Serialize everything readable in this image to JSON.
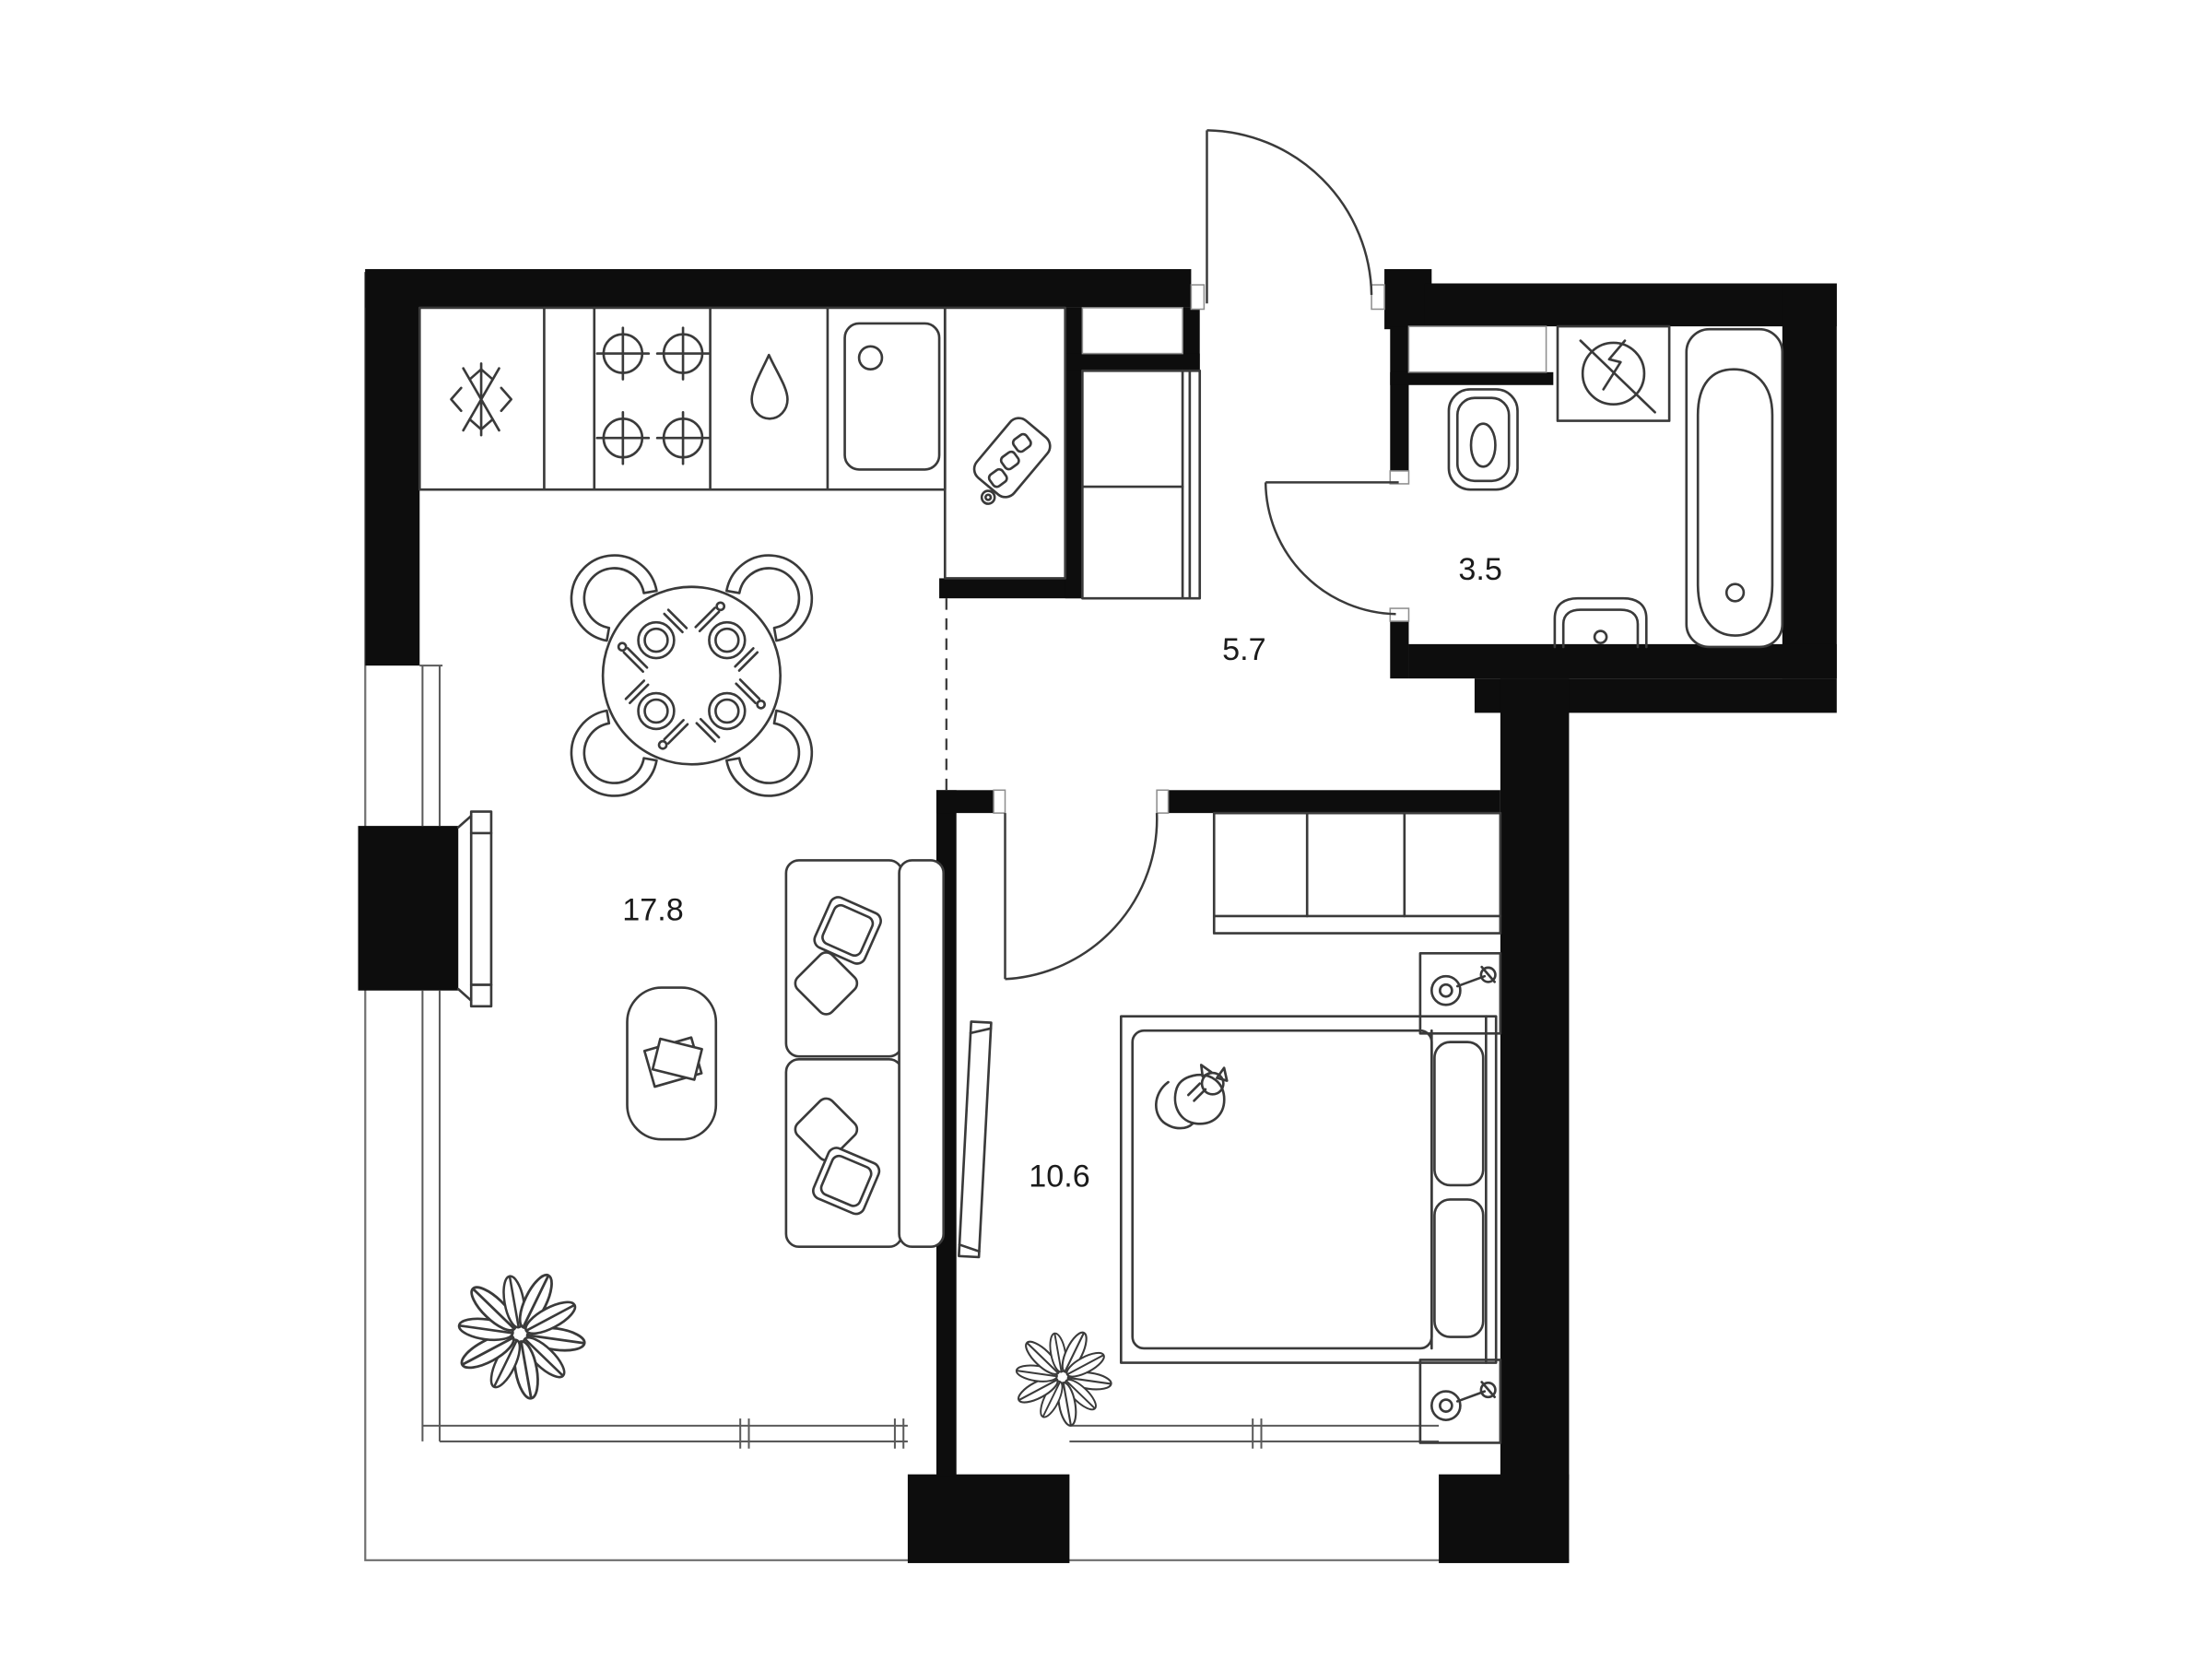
{
  "plan": {
    "type": "apartment-floor-plan",
    "rooms": [
      {
        "key": "living-kitchen",
        "area_label": "17.8"
      },
      {
        "key": "hallway",
        "area_label": "5.7"
      },
      {
        "key": "bathroom",
        "area_label": "3.5"
      },
      {
        "key": "bedroom",
        "area_label": "10.6"
      }
    ],
    "colors": {
      "wall": "#0d0d0d",
      "furniture_line": "#3a3a3a",
      "background": "#ffffff"
    },
    "icons": [
      "fridge-snowflake-icon",
      "stove-burners-icon",
      "dishwasher-drop-icon",
      "kitchen-sink-icon",
      "cutting-board-icon",
      "dining-table-icon",
      "chair-icon",
      "place-setting-icon",
      "sofa-icon",
      "pillow-icon",
      "coffee-table-icon",
      "plant-icon",
      "balcony-door-icon",
      "entrance-door-icon",
      "bathroom-door-icon",
      "bedroom-door-icon",
      "toilet-icon",
      "washing-machine-icon",
      "bathtub-icon",
      "bathroom-sink-icon",
      "duct-shaft-icon",
      "hall-closet-icon",
      "wardrobe-icon",
      "bed-icon",
      "cat-icon",
      "nightstand-icon",
      "wall-lamp-icon",
      "mirror-icon",
      "window-icon"
    ]
  }
}
